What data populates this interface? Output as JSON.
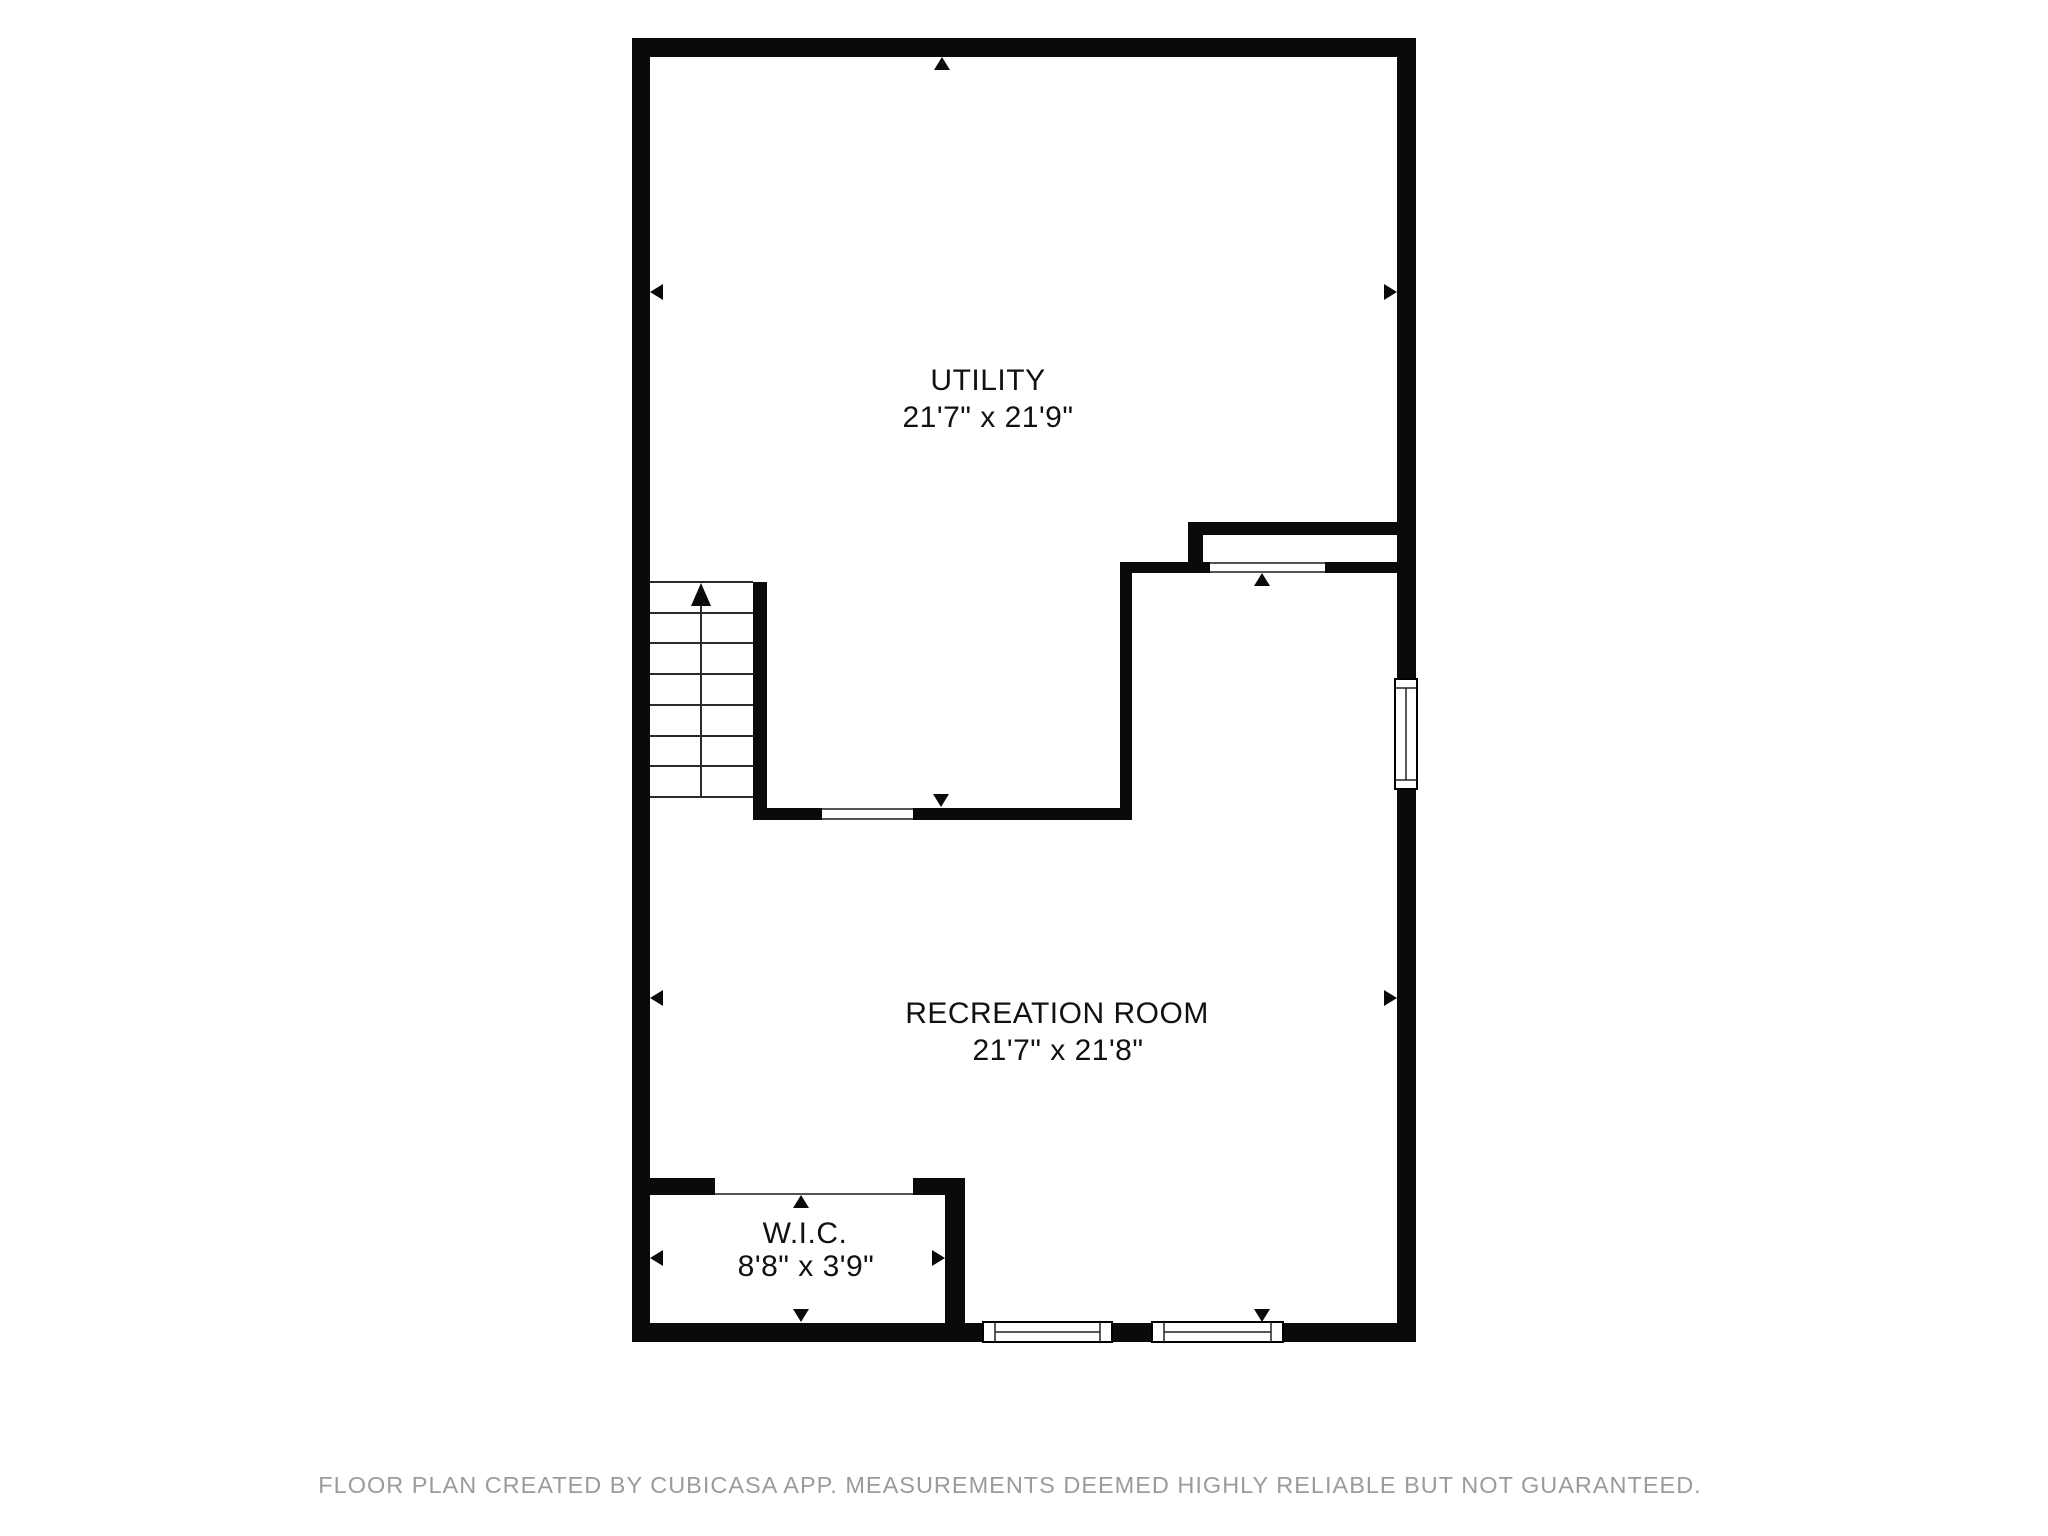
{
  "plan": {
    "rooms": [
      {
        "id": "utility",
        "name": "UTILITY",
        "dimensions": "21'7\" x 21'9\""
      },
      {
        "id": "recreation-room",
        "name": "RECREATION ROOM",
        "dimensions": "21'7\" x 21'8\""
      },
      {
        "id": "wic",
        "name": "W.I.C.",
        "dimensions": "8'8\" x 3'9\""
      }
    ],
    "icons": {
      "stairs_up_arrow": "up-arrow",
      "measurement_arrow": "solid-triangle"
    },
    "colors": {
      "wall": "#0a0a0a",
      "background": "#ffffff",
      "opening_line": "#555555",
      "stair_line": "#2a2a2a",
      "label_text": "#111111"
    }
  },
  "footer": {
    "text": "FLOOR PLAN CREATED BY CUBICASA APP. MEASUREMENTS DEEMED HIGHLY RELIABLE BUT NOT GUARANTEED.",
    "color": "#9b9b9b"
  }
}
